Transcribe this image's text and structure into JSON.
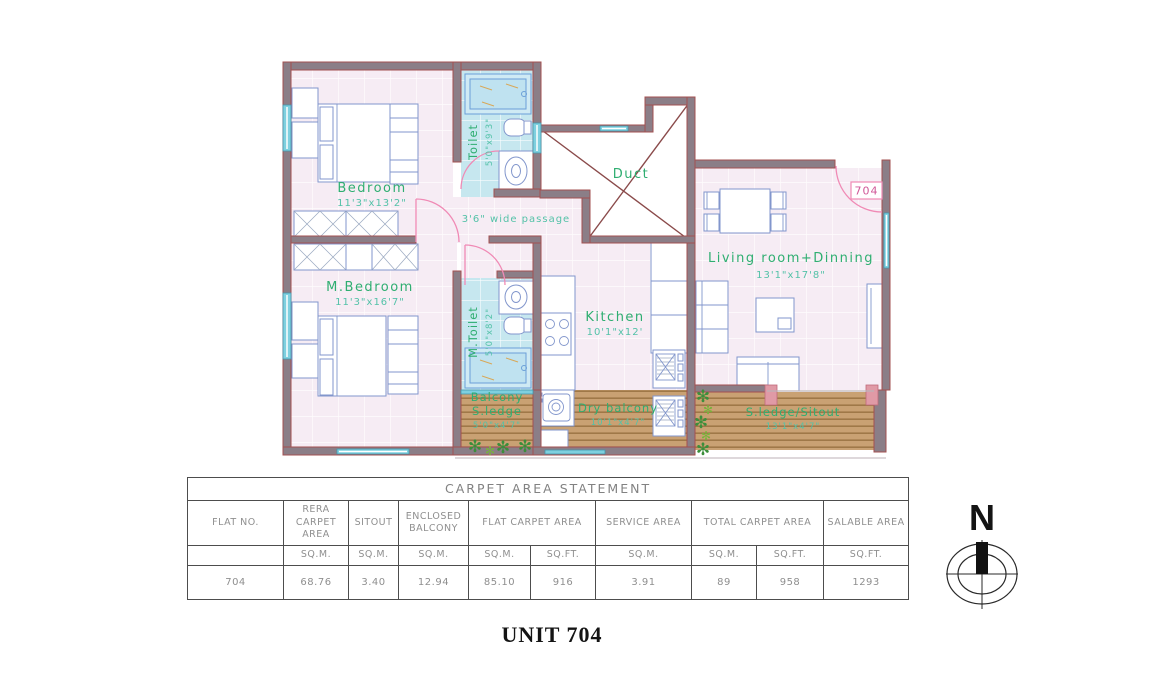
{
  "sheet": {
    "footer_title": "UNIT 704",
    "compass_label": "N"
  },
  "plan": {
    "door_number": "704",
    "passage_label": "3'6\" wide passage",
    "rooms": {
      "bedroom": {
        "name": "Bedroom",
        "dims": "11'3\"x13'2\""
      },
      "m_bedroom": {
        "name": "M.Bedroom",
        "dims": "11'3\"x16'7\""
      },
      "toilet": {
        "name": "Toilet",
        "dims": "5'0\"x9'3\""
      },
      "m_toilet": {
        "name": "M.Toilet",
        "dims": "5'0\"x8'2\""
      },
      "duct": {
        "name": "Duct"
      },
      "kitchen": {
        "name": "Kitchen",
        "dims": "10'1\"x12'"
      },
      "living": {
        "name": "Living room+Dinning",
        "dims": "13'1\"x17'8\""
      },
      "balcony": {
        "line1": "Balcony",
        "line2": "S.ledge",
        "dims": "5'0\"x4'7\""
      },
      "dry_balcony": {
        "name": "Dry balcony",
        "dims": "10'1\"x4'7\""
      },
      "sitout": {
        "name": "S.ledge/Sitout",
        "dims": "13'1\"x4'7\""
      }
    }
  },
  "table": {
    "title": "CARPET AREA STATEMENT",
    "columns": [
      "FLAT NO.",
      "RERA CARPET AREA",
      "SITOUT",
      "ENCLOSED BALCONY",
      "FLAT CARPET AREA",
      "SERVICE AREA",
      "TOTAL CARPET AREA",
      "SALABLE AREA"
    ],
    "units": [
      "",
      "SQ.M.",
      "SQ.M.",
      "SQ.M.",
      "SQ.M.",
      "SQ.FT.",
      "SQ.M.",
      "SQ.M.",
      "SQ.FT.",
      "SQ.FT."
    ],
    "values": [
      "704",
      "68.76",
      "3.40",
      "12.94",
      "85.10",
      "916",
      "3.91",
      "89",
      "958",
      "1293"
    ]
  },
  "colors": {
    "wall": "#8b7e87",
    "wall_edge": "#a35050",
    "floor": "#f6ecf4",
    "bath_floor": "#c6e7ef",
    "wood": "#c9a173",
    "room_label": "#2fae71",
    "dim_label": "#54c2a8",
    "door_arc": "#f08ab5",
    "furniture": "#8296cc",
    "window": "#7ed0df"
  }
}
